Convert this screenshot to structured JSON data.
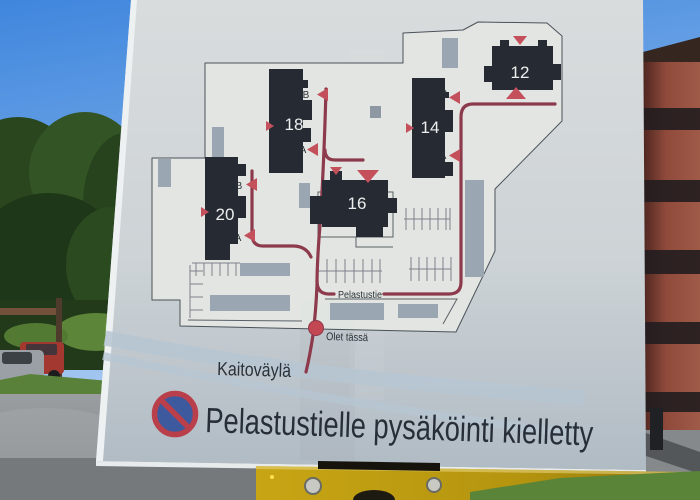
{
  "meta": {
    "scene": "Photograph of an outdoor residential site-map sign on a sunny day"
  },
  "sign": {
    "map": {
      "buildings": [
        {
          "number": "20",
          "entrances": [
            "B",
            "A"
          ]
        },
        {
          "number": "18",
          "entrances": [
            "B",
            "A"
          ]
        },
        {
          "number": "16",
          "entrances": []
        },
        {
          "number": "14",
          "entrances": [
            "B",
            "A"
          ]
        },
        {
          "number": "12",
          "entrances": []
        }
      ],
      "route_label": "Pelastustie",
      "you_are_here_label": "Olet tässä",
      "road_label": "Kaitoväylä"
    },
    "notice": {
      "icon": "no-parking",
      "text": "Pelastustielle pysäköinti kielletty"
    },
    "colors": {
      "map_background": "#e3e6e2",
      "building": "#262b33",
      "rescue_route": "#8d3a4c",
      "entrance_marker": "#c4505c",
      "carport": "#9aa6b2",
      "road_band": "#b6c6d2",
      "no_parking_blue": "#3d5a9e",
      "no_parking_red": "#b93f4a",
      "mount_yellow": "#b5950f"
    }
  }
}
